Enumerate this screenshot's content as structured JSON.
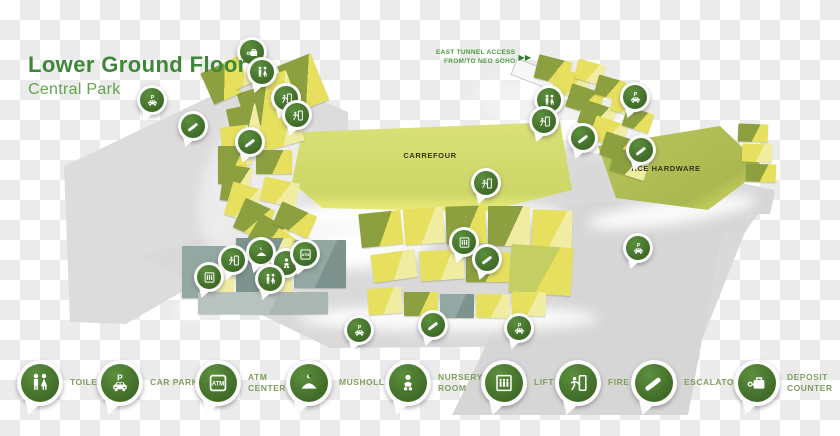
{
  "header": {
    "title": "Lower Ground Floor",
    "subtitle": "Central Park"
  },
  "map": {
    "tunnel": {
      "line1": "EAST TUNNEL ACCESS",
      "line2": "FROM/TO NEO SOHO",
      "arrows": "▶ ▶"
    },
    "areas": [
      {
        "label": "CARREFOUR"
      },
      {
        "label": "ACE HARDWARE"
      }
    ],
    "pins": [
      {
        "type": "deposit",
        "x": 252,
        "y": 52
      },
      {
        "type": "toilet",
        "x": 262,
        "y": 72
      },
      {
        "type": "carpark",
        "x": 152,
        "y": 100
      },
      {
        "type": "fireexit",
        "x": 286,
        "y": 98
      },
      {
        "type": "fireexit",
        "x": 297,
        "y": 115
      },
      {
        "type": "escalator",
        "x": 193,
        "y": 126
      },
      {
        "type": "escalator",
        "x": 250,
        "y": 142
      },
      {
        "type": "toilet",
        "x": 549,
        "y": 100
      },
      {
        "type": "fireexit",
        "x": 544,
        "y": 121
      },
      {
        "type": "carpark",
        "x": 635,
        "y": 97
      },
      {
        "type": "escalator",
        "x": 583,
        "y": 138
      },
      {
        "type": "escalator",
        "x": 641,
        "y": 150
      },
      {
        "type": "fireexit",
        "x": 486,
        "y": 183
      },
      {
        "type": "lift",
        "x": 464,
        "y": 242
      },
      {
        "type": "escalator",
        "x": 487,
        "y": 259
      },
      {
        "type": "musholla",
        "x": 261,
        "y": 252
      },
      {
        "type": "fireexit",
        "x": 233,
        "y": 260
      },
      {
        "type": "nursery",
        "x": 286,
        "y": 263
      },
      {
        "type": "atm",
        "x": 305,
        "y": 254
      },
      {
        "type": "toilet",
        "x": 270,
        "y": 279
      },
      {
        "type": "lift",
        "x": 209,
        "y": 277
      },
      {
        "type": "carpark",
        "x": 359,
        "y": 330
      },
      {
        "type": "escalator",
        "x": 433,
        "y": 325
      },
      {
        "type": "carpark",
        "x": 519,
        "y": 328
      },
      {
        "type": "carpark",
        "x": 638,
        "y": 248
      }
    ]
  },
  "legend": {
    "items": [
      {
        "icon": "toilet",
        "label": "TOILET"
      },
      {
        "icon": "carpark",
        "label": "CAR PARK"
      },
      {
        "icon": "atm",
        "label": "ATM CENTER"
      },
      {
        "icon": "musholla",
        "label": "MUSHOLLA"
      },
      {
        "icon": "nursery",
        "label": "NURSERY ROOM"
      },
      {
        "icon": "lift",
        "label": "LIFT"
      },
      {
        "icon": "fireexit",
        "label": "FIRE EXIT"
      },
      {
        "icon": "escalator",
        "label": "ESCALATOR"
      },
      {
        "icon": "deposit",
        "label": "DEPOSIT COUNTER"
      }
    ]
  },
  "colors": {
    "pin_green": "#46742c",
    "title_green": "#3e8638",
    "subtitle_green": "#63a44d",
    "legend_label_green": "#7f9e5d",
    "block_olive": "#8ca03f",
    "block_yellow": "#e6e05e",
    "carrefour_top": "#d6dd7b",
    "ace_top": "#b7c258",
    "platform_gray": "#dadada"
  }
}
